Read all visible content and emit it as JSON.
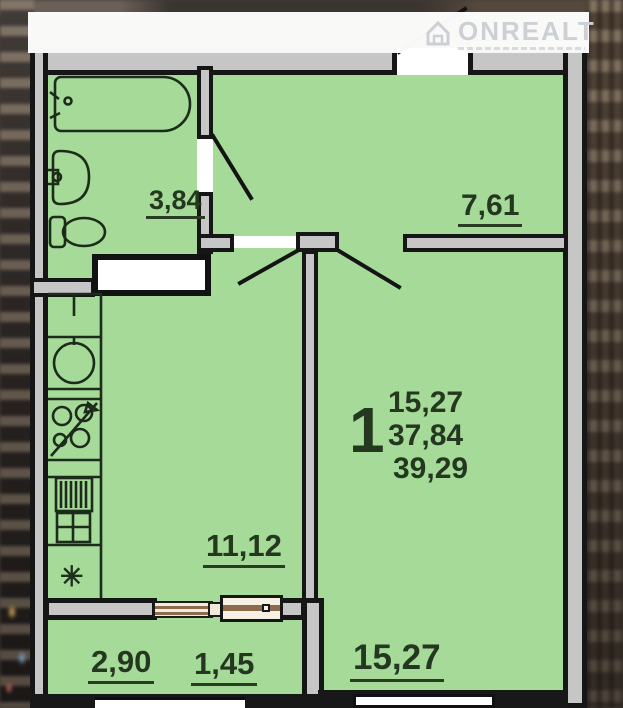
{
  "watermark": {
    "brand": "ONREALT",
    "icon": "house-icon"
  },
  "unit": {
    "rooms_count": "1",
    "area_living": "15,27",
    "area_total": "37,84",
    "area_overall": "39,29"
  },
  "rooms": {
    "bathroom": {
      "area": "3,84"
    },
    "hallway": {
      "area": "7,61"
    },
    "kitchen": {
      "area": "11,12"
    },
    "living_room": {
      "area": "15,27"
    },
    "balcony": {
      "area_a": "2,90",
      "area_b": "1,45"
    }
  },
  "symbols": {
    "fridge_snowflake": "✳"
  },
  "colors": {
    "room_fill": "#a5da99",
    "wall_core": "#c6c6c6",
    "wall_outline": "#161616",
    "label_text": "#24371f",
    "window_frame": "#8d6b4f",
    "watermark_gray": "#ccd0d4"
  }
}
